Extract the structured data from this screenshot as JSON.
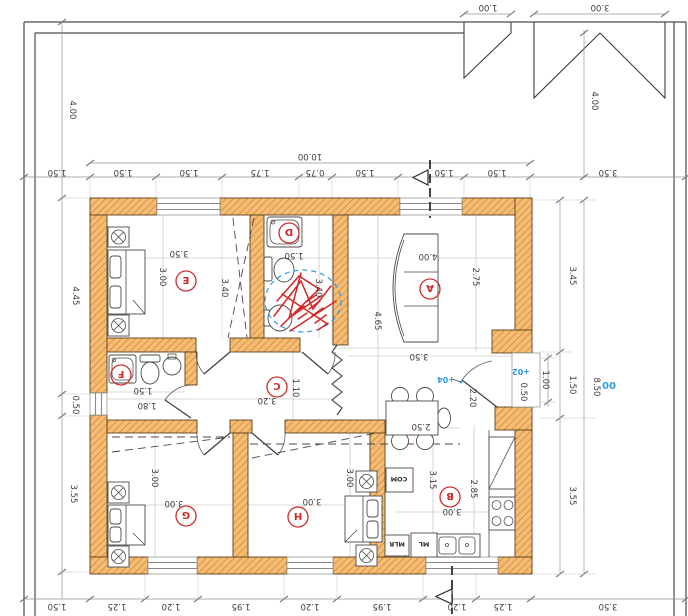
{
  "document": {
    "type": "architectural-floor-plan"
  },
  "colors": {
    "wall_fill": "#f5bc72",
    "wall_hatch": "#c2803a",
    "red": "#cc2b2b",
    "blue": "#2e9be6",
    "ink": "#3c3c3c",
    "dim": "#8c8c8c"
  },
  "site": {
    "top_dims": [
      "1.00",
      "3.00"
    ]
  },
  "dims": {
    "top_overall": "10.00",
    "top": [
      "1.50",
      "1.50",
      "1.50",
      "1.75",
      "0.75",
      "1.50",
      "1.50",
      "1.50",
      "3.50"
    ],
    "bottom": [
      "1.50",
      "1.25",
      "1.20",
      "1.95",
      "1.20",
      "1.95",
      "1.20",
      "1.25",
      "3.50"
    ],
    "left": [
      "4.00",
      "4.45",
      "0.50",
      "3.55"
    ],
    "right": [
      "4.00",
      "3.45",
      "1.50",
      "3.55",
      "8.50"
    ],
    "porch": [
      "0.50",
      "1.00",
      "2.20"
    ]
  },
  "rooms": {
    "A": {
      "label": "A",
      "dims": [
        "4.00",
        "2.75",
        "4.65",
        "3.50"
      ]
    },
    "B": {
      "label": "B",
      "dims": [
        "2.50",
        "3.15",
        "2.85",
        "3.00"
      ]
    },
    "C": {
      "label": "C",
      "dims": [
        "3.20",
        "1.10"
      ]
    },
    "D": {
      "label": "D",
      "dims": [
        "1.50",
        "3.40"
      ]
    },
    "E": {
      "label": "E",
      "dims": [
        "3.50",
        "3.00",
        "3.40"
      ]
    },
    "F": {
      "label": "F",
      "dims": [
        "1.50",
        "1.80"
      ]
    },
    "G": {
      "label": "G",
      "dims": [
        "3.00",
        "3.00"
      ]
    },
    "H": {
      "label": "H",
      "dims": [
        "3.00",
        "3.00"
      ]
    }
  },
  "kitchen": {
    "com": "COM",
    "ml": "ML",
    "mlr": "MLR"
  },
  "elevations": {
    "entry": "+04",
    "porch": "+02",
    "ground": "00"
  }
}
